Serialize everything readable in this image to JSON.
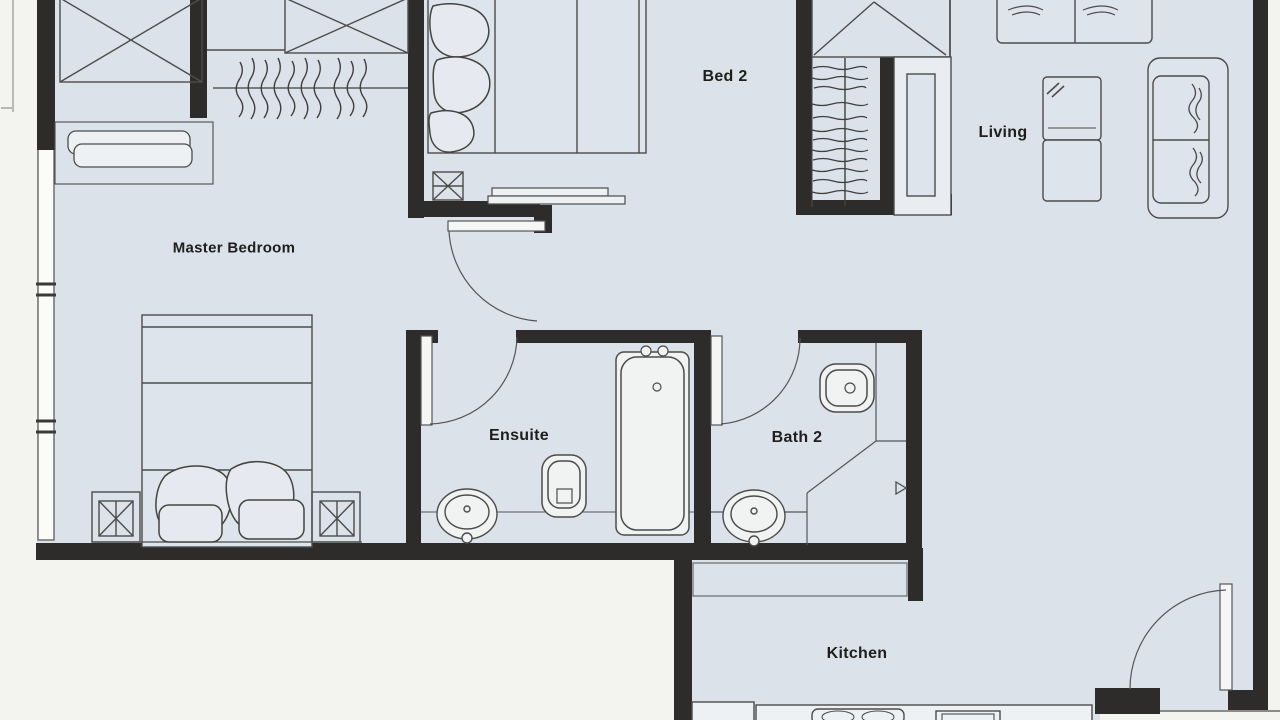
{
  "plan": {
    "type": "apartment-floor-plan",
    "rooms": [
      {
        "name": "master-bedroom",
        "label": "Master Bedroom"
      },
      {
        "name": "bed-2",
        "label": "Bed 2"
      },
      {
        "name": "living",
        "label": "Living"
      },
      {
        "name": "ensuite",
        "label": "Ensuite"
      },
      {
        "name": "bath-2",
        "label": "Bath 2"
      },
      {
        "name": "kitchen",
        "label": "Kitchen"
      }
    ],
    "fixtures": [
      "wardrobe-icon",
      "hanging-clothes-icon",
      "dresser-icon",
      "double-bed-icon",
      "nightstand-icon",
      "single-bed-icon",
      "desk-shelf-icon",
      "linen-shelves-icon",
      "tall-cabinet-icon",
      "sofa-icon",
      "armchair-icon",
      "toilet-icon",
      "basin-icon",
      "bathtub-icon",
      "shower-icon",
      "door-swing-icon",
      "window-icon",
      "kitchen-counter-icon",
      "sink-icon",
      "cooktop-icon"
    ],
    "colors": {
      "floor": "#dbe2e9",
      "wall": "#2d2c2a",
      "line": "#4c4c4a",
      "paper": "#f3f3f0",
      "fixture_white": "#f4f5f3",
      "furniture_fill": "#e2e7ee"
    }
  }
}
